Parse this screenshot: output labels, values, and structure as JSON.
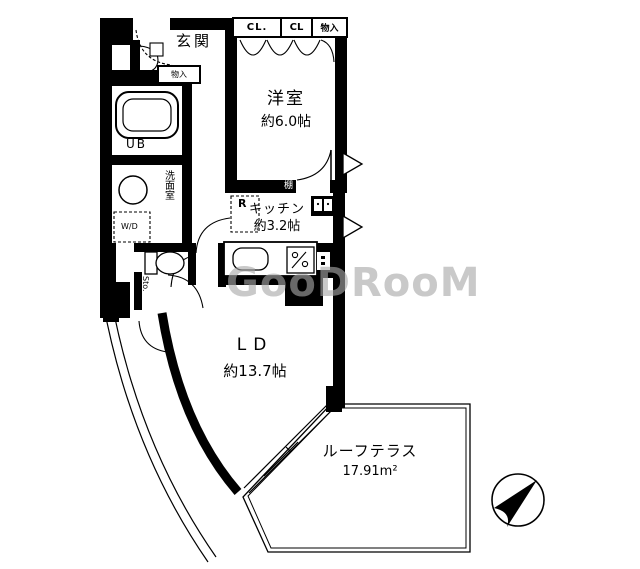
{
  "colors": {
    "line": "#000000",
    "background": "#ffffff",
    "watermark": "#a8a8a8"
  },
  "watermark": {
    "text": "GooDRooM"
  },
  "compass": {
    "points_to": "northeast"
  },
  "labels": {
    "genkan": "玄関",
    "monoire_hall": "物入",
    "closet1": "CL.",
    "closet2": "CL",
    "closet3": "物入",
    "yoshitsu_name": "洋室",
    "yoshitsu_size": "約6.0帖",
    "ub": "UB",
    "senmen": "洗面室",
    "wd": "W/D",
    "toilet": "トイレ",
    "sto": "Sto.",
    "shelf": "棚",
    "fridge": "R",
    "kitchen_name": "キッチン",
    "kitchen_size": "約3.2帖",
    "ld_name": "LD",
    "ld_size": "約13.7帖",
    "terrace_name": "ルーフテラス",
    "terrace_area": "17.91m²"
  }
}
